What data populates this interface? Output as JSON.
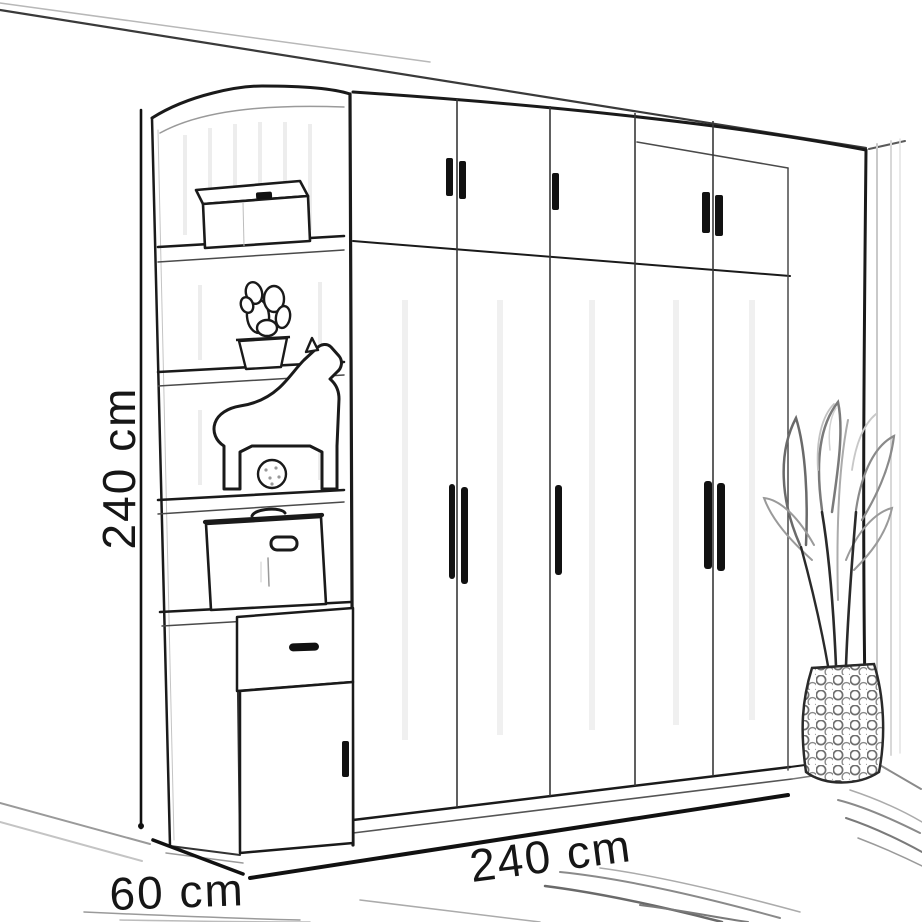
{
  "dimensions": {
    "height": {
      "label": "240 cm"
    },
    "width": {
      "label": "240 cm"
    },
    "depth": {
      "label": "60 cm"
    }
  },
  "colors": {
    "ink": "#1a1a1a",
    "sketch_gray": "#8a8a8a",
    "light_gray": "#c9c9c9",
    "background": "#ffffff"
  },
  "objects": [
    "wardrobe",
    "upper-cabinet-doors",
    "wardrobe-doors",
    "door-handles",
    "corner-shelf-unit",
    "storage-box",
    "potted-cactus",
    "toy-horse",
    "storage-case",
    "drawer",
    "base-cabinet-door",
    "potted-plant",
    "rug",
    "room-walls"
  ]
}
